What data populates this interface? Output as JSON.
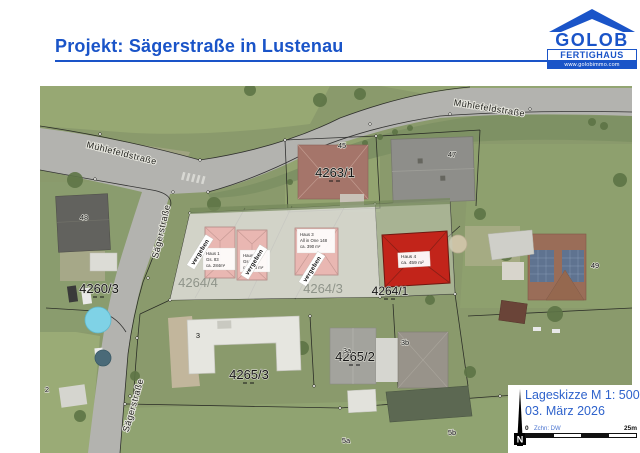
{
  "header": {
    "title": "Projekt: Sägerstraße in Lustenau"
  },
  "logo": {
    "name": "GOLOB",
    "division": "FERTIGHAUS",
    "website": "www.golobimmo.com"
  },
  "map": {
    "street_labels": [
      {
        "id": "muehlefeldstrasse-west",
        "text": "Mühlefeldstraße"
      },
      {
        "id": "muehlefeldstrasse-east",
        "text": "Mühlefeldstraße"
      },
      {
        "id": "saegerstrasse-north",
        "text": "Sägerstraße"
      },
      {
        "id": "saegerstrasse-south",
        "text": "Sägerstraße"
      }
    ],
    "parcel_labels": [
      {
        "id": "4260-3",
        "text": "4260/3"
      },
      {
        "id": "4263-1",
        "text": "4263/1"
      },
      {
        "id": "4264-4",
        "text": "4264/4"
      },
      {
        "id": "4264-3",
        "text": "4264/3"
      },
      {
        "id": "4264-1",
        "text": "4264/1"
      },
      {
        "id": "4265-3",
        "text": "4265/3"
      },
      {
        "id": "4265-2",
        "text": "4265/2"
      }
    ],
    "house_numbers": [
      "45",
      "47",
      "48",
      "49",
      "3",
      "3a",
      "3b",
      "5a",
      "5b",
      "2"
    ],
    "planned_houses": [
      {
        "name": "Haus 1",
        "lines": [
          "Haus 1",
          "Gs. 83",
          "ca. 284m²"
        ]
      },
      {
        "name": "Haus 2",
        "lines": [
          "Haus 2",
          "Gs. 84",
          "ca. 288 m²"
        ]
      },
      {
        "name": "Haus 3",
        "lines": [
          "Haus 3",
          "All in One 148",
          "ca. 390 m²"
        ]
      },
      {
        "name": "Haus 4",
        "lines": [
          "Haus 4",
          "ca. 459 m²"
        ]
      }
    ],
    "banner_label": "vergeben"
  },
  "legend": {
    "title": "Lageskizze M 1: 500",
    "date": "03. März 2026",
    "north_label": "N",
    "scale_zero": "0",
    "scale_max": "25m",
    "credit": "Zchn: DW"
  },
  "colors": {
    "accent_blue": "#1a54c8",
    "highlight_red": "#c2241a",
    "planned_pink": "#e9b7b2",
    "road_gray": "#b3b3af",
    "grass_green": "#8a9a6c"
  }
}
